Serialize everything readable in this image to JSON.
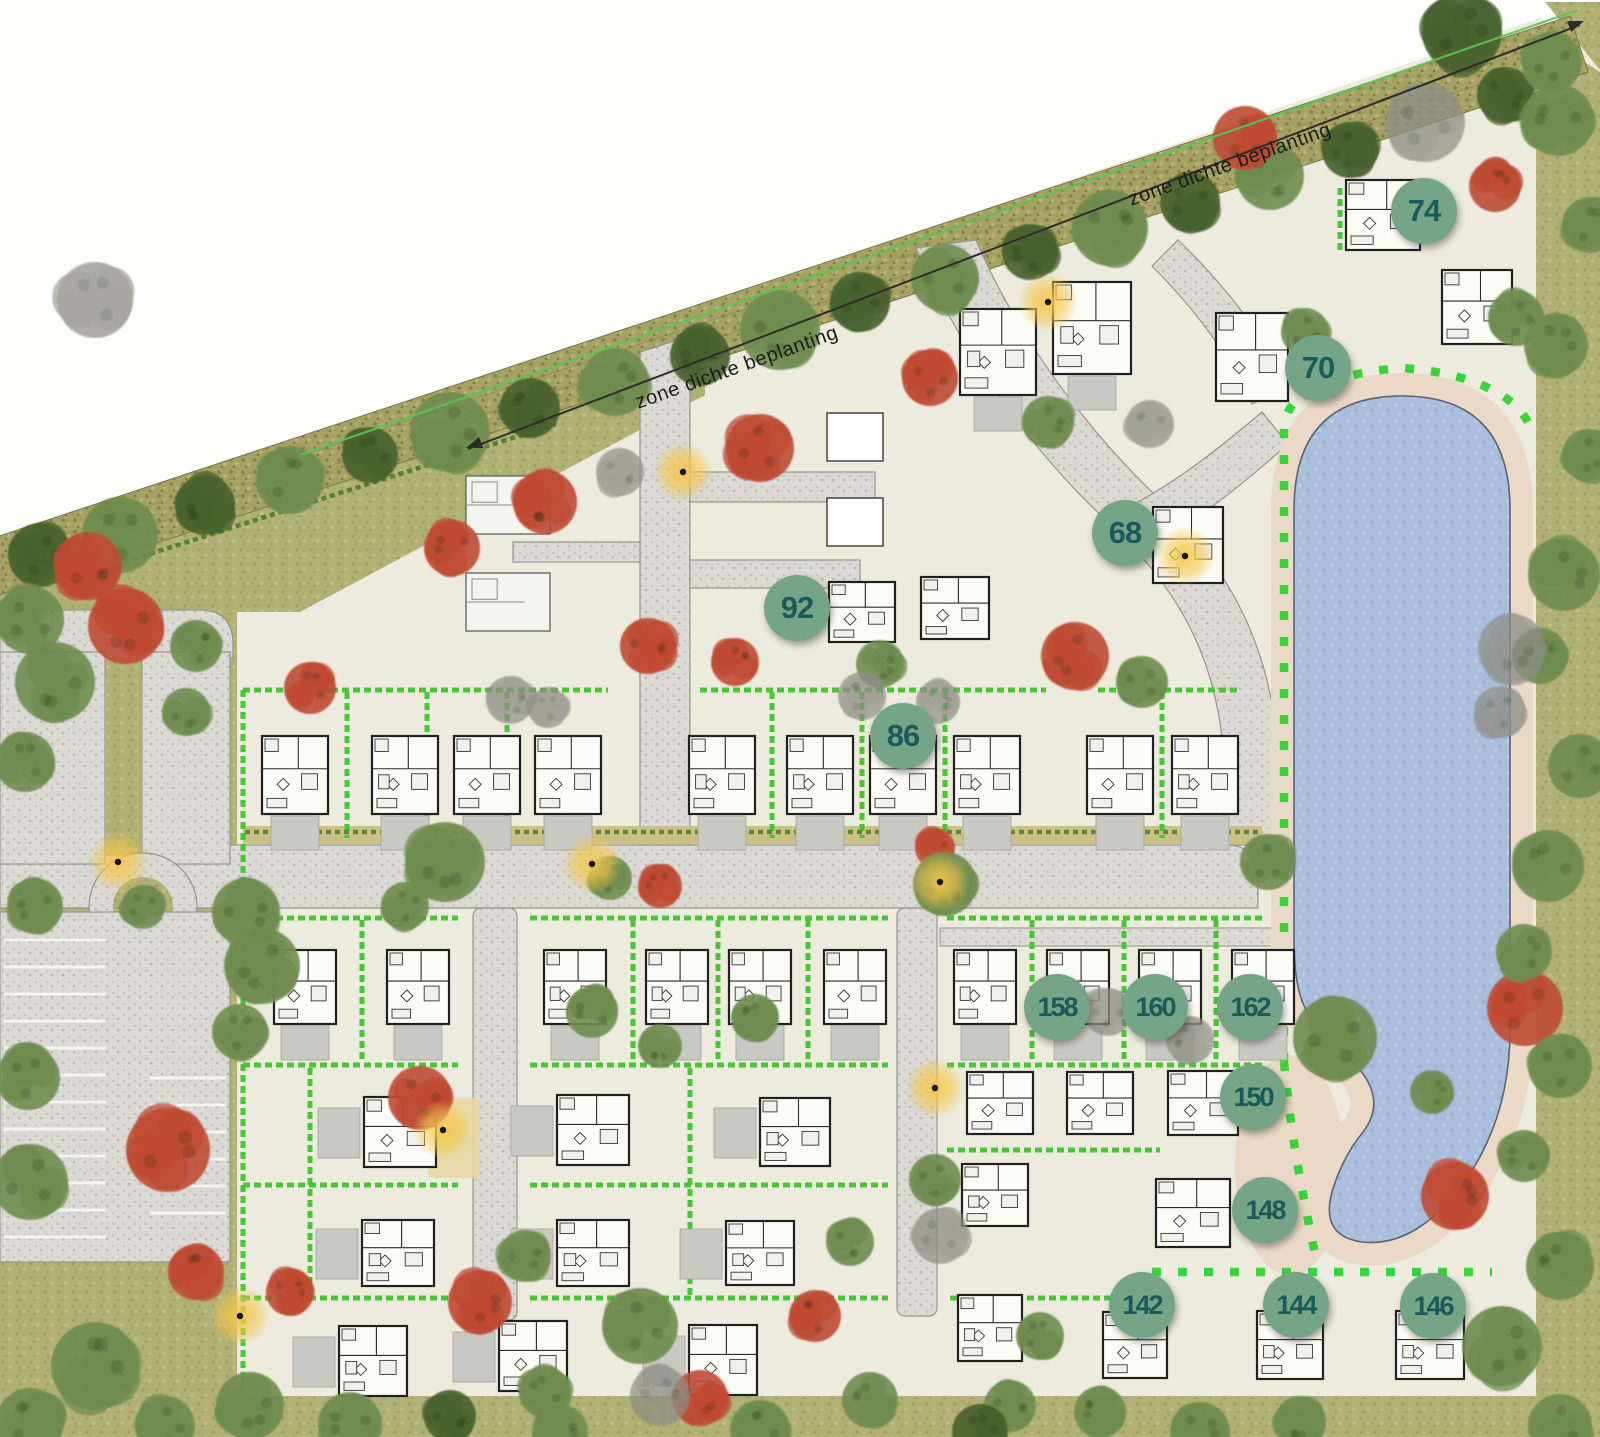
{
  "plan": {
    "colors": {
      "badge_fill": "#76a487",
      "badge_text": "#1b5a58",
      "water": "#a9bedd",
      "sand": "#ead9c6",
      "grass": "#b2b175",
      "lot": "#ecebdd",
      "road": "#dad9d3",
      "hedge_bright": "#3fc42c",
      "tree_green": "#6f8c4f",
      "tree_dark": "#47612e",
      "tree_red": "#bf4a34",
      "tree_gray": "#8d8d85",
      "lamp_glow": "#f5c64b"
    },
    "zone_labels": [
      {
        "text": "zone dichte beplanting",
        "x": 737,
        "y": 368,
        "angle": -19.5
      },
      {
        "text": "zone dichte beplanting",
        "x": 1230,
        "y": 165,
        "angle": -19.5
      }
    ],
    "badges": [
      {
        "label": "74",
        "x": 1424,
        "y": 211
      },
      {
        "label": "70",
        "x": 1318,
        "y": 368
      },
      {
        "label": "68",
        "x": 1125,
        "y": 533
      },
      {
        "label": "92",
        "x": 797,
        "y": 608
      },
      {
        "label": "86",
        "x": 903,
        "y": 736
      },
      {
        "label": "158",
        "x": 1057,
        "y": 1007
      },
      {
        "label": "160",
        "x": 1155,
        "y": 1007
      },
      {
        "label": "162",
        "x": 1250,
        "y": 1007
      },
      {
        "label": "150",
        "x": 1253,
        "y": 1097
      },
      {
        "label": "148",
        "x": 1265,
        "y": 1210
      },
      {
        "label": "142",
        "x": 1142,
        "y": 1305
      },
      {
        "label": "144",
        "x": 1296,
        "y": 1305
      },
      {
        "label": "146",
        "x": 1433,
        "y": 1306
      }
    ],
    "houses": [
      [
        295,
        775,
        66,
        78,
        "p",
        1
      ],
      [
        405,
        775,
        66,
        78,
        "p",
        1
      ],
      [
        487,
        775,
        66,
        78,
        "p",
        1
      ],
      [
        568,
        775,
        66,
        78,
        "p",
        1
      ],
      [
        722,
        775,
        66,
        78,
        "p",
        1
      ],
      [
        820,
        775,
        66,
        78,
        "p",
        1
      ],
      [
        903,
        775,
        66,
        78,
        "p",
        1
      ],
      [
        987,
        775,
        66,
        78,
        "p",
        1
      ],
      [
        1120,
        775,
        66,
        78,
        "p",
        1
      ],
      [
        1205,
        775,
        66,
        78,
        "p",
        1
      ],
      [
        305,
        987,
        62,
        74,
        "p",
        1
      ],
      [
        418,
        987,
        62,
        74,
        "p",
        1
      ],
      [
        575,
        987,
        62,
        74,
        "p",
        1
      ],
      [
        677,
        987,
        62,
        74,
        "p",
        1
      ],
      [
        760,
        987,
        62,
        74,
        "p",
        1
      ],
      [
        855,
        987,
        62,
        74,
        "p",
        1
      ],
      [
        985,
        987,
        62,
        74,
        "p",
        1
      ],
      [
        1078,
        987,
        62,
        74,
        "p",
        1
      ],
      [
        1170,
        987,
        62,
        74,
        "p",
        1
      ],
      [
        1263,
        987,
        62,
        74,
        "p",
        1
      ],
      [
        400,
        1132,
        72,
        70,
        "p",
        2
      ],
      [
        593,
        1130,
        72,
        70,
        "p",
        2
      ],
      [
        795,
        1132,
        70,
        68,
        "p",
        2
      ],
      [
        1000,
        1103,
        66,
        62,
        "p",
        0
      ],
      [
        1100,
        1103,
        66,
        62,
        "p",
        0
      ],
      [
        1203,
        1103,
        70,
        64,
        "p",
        0
      ],
      [
        398,
        1253,
        72,
        66,
        "p",
        2
      ],
      [
        593,
        1253,
        72,
        66,
        "p",
        2
      ],
      [
        760,
        1253,
        68,
        64,
        "p",
        2
      ],
      [
        995,
        1195,
        66,
        62,
        "p",
        0
      ],
      [
        1193,
        1213,
        74,
        68,
        "p",
        0
      ],
      [
        373,
        1361,
        68,
        70,
        "p",
        2
      ],
      [
        533,
        1356,
        68,
        70,
        "p",
        2
      ],
      [
        723,
        1360,
        68,
        70,
        "p",
        2
      ],
      [
        990,
        1328,
        64,
        66,
        "p",
        0
      ],
      [
        1135,
        1345,
        64,
        66,
        "p",
        0
      ],
      [
        1290,
        1345,
        66,
        68,
        "p",
        0
      ],
      [
        1430,
        1345,
        68,
        68,
        "p",
        0
      ],
      [
        998,
        352,
        76,
        86,
        "p",
        1
      ],
      [
        1092,
        328,
        78,
        92,
        "p",
        1
      ],
      [
        862,
        612,
        66,
        60,
        "p",
        0
      ],
      [
        955,
        608,
        68,
        62,
        "p",
        0
      ],
      [
        1188,
        545,
        70,
        76,
        "p",
        0
      ],
      [
        1252,
        357,
        72,
        88,
        "p",
        0
      ],
      [
        1383,
        215,
        74,
        70,
        "p",
        0
      ],
      [
        1477,
        307,
        70,
        74,
        "p",
        0
      ],
      [
        508,
        505,
        84,
        58,
        "l",
        0
      ],
      [
        508,
        602,
        84,
        58,
        "l",
        0
      ],
      [
        855,
        437,
        56,
        48,
        "b",
        0
      ],
      [
        855,
        522,
        56,
        48,
        "b",
        0
      ]
    ],
    "trees": [
      [
        40,
        555,
        32,
        "d"
      ],
      [
        120,
        535,
        38,
        "g"
      ],
      [
        205,
        505,
        30,
        "d"
      ],
      [
        290,
        480,
        34,
        "g"
      ],
      [
        370,
        455,
        28,
        "d"
      ],
      [
        450,
        432,
        40,
        "g"
      ],
      [
        530,
        408,
        30,
        "d"
      ],
      [
        615,
        382,
        34,
        "g"
      ],
      [
        700,
        356,
        30,
        "d"
      ],
      [
        780,
        330,
        40,
        "g"
      ],
      [
        860,
        302,
        30,
        "d"
      ],
      [
        945,
        278,
        34,
        "g"
      ],
      [
        1030,
        252,
        28,
        "d"
      ],
      [
        1110,
        228,
        38,
        "g"
      ],
      [
        1190,
        202,
        30,
        "d"
      ],
      [
        1270,
        176,
        34,
        "g"
      ],
      [
        1350,
        150,
        28,
        "d"
      ],
      [
        1425,
        122,
        40,
        "k"
      ],
      [
        1462,
        32,
        40,
        "d"
      ],
      [
        1505,
        95,
        28,
        "d"
      ],
      [
        1552,
        62,
        30,
        "g"
      ],
      [
        95,
        300,
        38,
        "k"
      ],
      [
        30,
        620,
        34,
        "g"
      ],
      [
        55,
        682,
        40,
        "g"
      ],
      [
        25,
        762,
        30,
        "g"
      ],
      [
        196,
        646,
        26,
        "g"
      ],
      [
        186,
        712,
        24,
        "g"
      ],
      [
        35,
        906,
        28,
        "g"
      ],
      [
        246,
        912,
        34,
        "g"
      ],
      [
        262,
        966,
        38,
        "g"
      ],
      [
        240,
        1032,
        28,
        "g"
      ],
      [
        28,
        1078,
        32,
        "g"
      ],
      [
        30,
        1182,
        38,
        "g"
      ],
      [
        95,
        1366,
        44,
        "g"
      ],
      [
        30,
        1422,
        34,
        "g"
      ],
      [
        165,
        1426,
        30,
        "g"
      ],
      [
        88,
        566,
        34,
        "r"
      ],
      [
        126,
        626,
        38,
        "r"
      ],
      [
        168,
        1150,
        42,
        "r"
      ],
      [
        196,
        1272,
        28,
        "r"
      ],
      [
        143,
        907,
        22,
        "g"
      ],
      [
        545,
        502,
        32,
        "r"
      ],
      [
        452,
        548,
        28,
        "r"
      ],
      [
        620,
        472,
        24,
        "k"
      ],
      [
        760,
        448,
        34,
        "r"
      ],
      [
        930,
        378,
        28,
        "r"
      ],
      [
        1048,
        422,
        26,
        "g"
      ],
      [
        1150,
        424,
        24,
        "k"
      ],
      [
        1245,
        138,
        32,
        "r"
      ],
      [
        1495,
        186,
        26,
        "r"
      ],
      [
        1305,
        332,
        24,
        "g"
      ],
      [
        1516,
        318,
        28,
        "g"
      ],
      [
        648,
        646,
        28,
        "r"
      ],
      [
        735,
        662,
        24,
        "r"
      ],
      [
        880,
        664,
        24,
        "g"
      ],
      [
        862,
        696,
        24,
        "k"
      ],
      [
        938,
        702,
        22,
        "k"
      ],
      [
        1075,
        656,
        34,
        "r"
      ],
      [
        1142,
        682,
        26,
        "g"
      ],
      [
        445,
        862,
        40,
        "g"
      ],
      [
        405,
        906,
        24,
        "g"
      ],
      [
        610,
        878,
        22,
        "g"
      ],
      [
        660,
        886,
        22,
        "r"
      ],
      [
        935,
        848,
        20,
        "r"
      ],
      [
        945,
        884,
        32,
        "g"
      ],
      [
        1268,
        862,
        28,
        "g"
      ],
      [
        310,
        688,
        26,
        "r"
      ],
      [
        510,
        700,
        24,
        "k"
      ],
      [
        548,
        708,
        20,
        "k"
      ],
      [
        592,
        1012,
        26,
        "g"
      ],
      [
        660,
        1046,
        22,
        "g"
      ],
      [
        755,
        1018,
        24,
        "g"
      ],
      [
        1108,
        1012,
        24,
        "k"
      ],
      [
        1190,
        1040,
        24,
        "k"
      ],
      [
        935,
        1180,
        26,
        "g"
      ],
      [
        850,
        1242,
        24,
        "g"
      ],
      [
        940,
        1236,
        28,
        "k"
      ],
      [
        525,
        1256,
        26,
        "g"
      ],
      [
        420,
        1098,
        32,
        "r"
      ],
      [
        290,
        1292,
        24,
        "r"
      ],
      [
        480,
        1302,
        32,
        "r"
      ],
      [
        640,
        1326,
        38,
        "g"
      ],
      [
        815,
        1316,
        26,
        "r"
      ],
      [
        700,
        1398,
        28,
        "r"
      ],
      [
        870,
        1400,
        28,
        "g"
      ],
      [
        1040,
        1336,
        24,
        "g"
      ],
      [
        1010,
        1406,
        26,
        "g"
      ],
      [
        660,
        1396,
        30,
        "k"
      ],
      [
        545,
        1392,
        26,
        "g"
      ],
      [
        350,
        1424,
        32,
        "g"
      ],
      [
        450,
        1416,
        26,
        "d"
      ],
      [
        250,
        1406,
        34,
        "g"
      ],
      [
        560,
        1432,
        28,
        "g"
      ],
      [
        760,
        1430,
        30,
        "g"
      ],
      [
        980,
        1432,
        28,
        "d"
      ],
      [
        1100,
        1412,
        26,
        "g"
      ],
      [
        1200,
        1432,
        30,
        "g"
      ],
      [
        1300,
        1422,
        26,
        "g"
      ],
      [
        1335,
        1038,
        42,
        "g"
      ],
      [
        1525,
        1008,
        38,
        "r"
      ],
      [
        1558,
        120,
        36,
        "g"
      ],
      [
        1590,
        225,
        28,
        "g"
      ],
      [
        1556,
        345,
        32,
        "g"
      ],
      [
        1588,
        455,
        26,
        "g"
      ],
      [
        1564,
        575,
        36,
        "g"
      ],
      [
        1540,
        656,
        28,
        "g"
      ],
      [
        1580,
        766,
        32,
        "g"
      ],
      [
        1548,
        866,
        36,
        "g"
      ],
      [
        1524,
        952,
        28,
        "g"
      ],
      [
        1560,
        1066,
        32,
        "g"
      ],
      [
        1524,
        1156,
        26,
        "g"
      ],
      [
        1560,
        1266,
        34,
        "g"
      ],
      [
        1502,
        1346,
        40,
        "g"
      ],
      [
        1560,
        1426,
        32,
        "g"
      ],
      [
        1455,
        1196,
        34,
        "r"
      ],
      [
        1432,
        1092,
        22,
        "g"
      ],
      [
        1512,
        648,
        34,
        "k"
      ],
      [
        1500,
        712,
        26,
        "k"
      ]
    ],
    "lamps": [
      [
        683,
        472
      ],
      [
        1048,
        302
      ],
      [
        592,
        864
      ],
      [
        940,
        882
      ],
      [
        1185,
        556
      ],
      [
        443,
        1130
      ],
      [
        935,
        1088
      ],
      [
        240,
        1316
      ],
      [
        118,
        862
      ]
    ],
    "hedges": [
      "M243 690 H608",
      "M700 690 H1046",
      "M1098 690 H1240",
      "M243 690 V1396",
      "M347 692 V838",
      "M427 692 V838",
      "M507 692 V838",
      "M772 692 V838",
      "M862 692 V838",
      "M945 692 V838",
      "M1162 692 V838",
      "M243 918 H458",
      "M530 918 H888",
      "M947 918 H1262",
      "M362 920 V1062",
      "M633 920 V1062",
      "M718 920 V1062",
      "M808 920 V1062",
      "M1032 920 V1062",
      "M1124 920 V1062",
      "M1216 920 V1062",
      "M243 1065 H458",
      "M530 1065 H888",
      "M947 1065 H1262",
      "M243 1185 H458",
      "M530 1185 H888",
      "M243 1298 H458",
      "M530 1298 H888",
      "M950 1298 H1128",
      "M310 1068 V1296",
      "M690 1068 V1296",
      "M947 1150 H1160",
      "M1340 188 V250"
    ],
    "hedges_dark": [
      "M90 573 L556 424",
      "M245 832 H1260"
    ],
    "parking": {
      "x": 0,
      "y": 912,
      "w": 230,
      "h": 350
    }
  }
}
